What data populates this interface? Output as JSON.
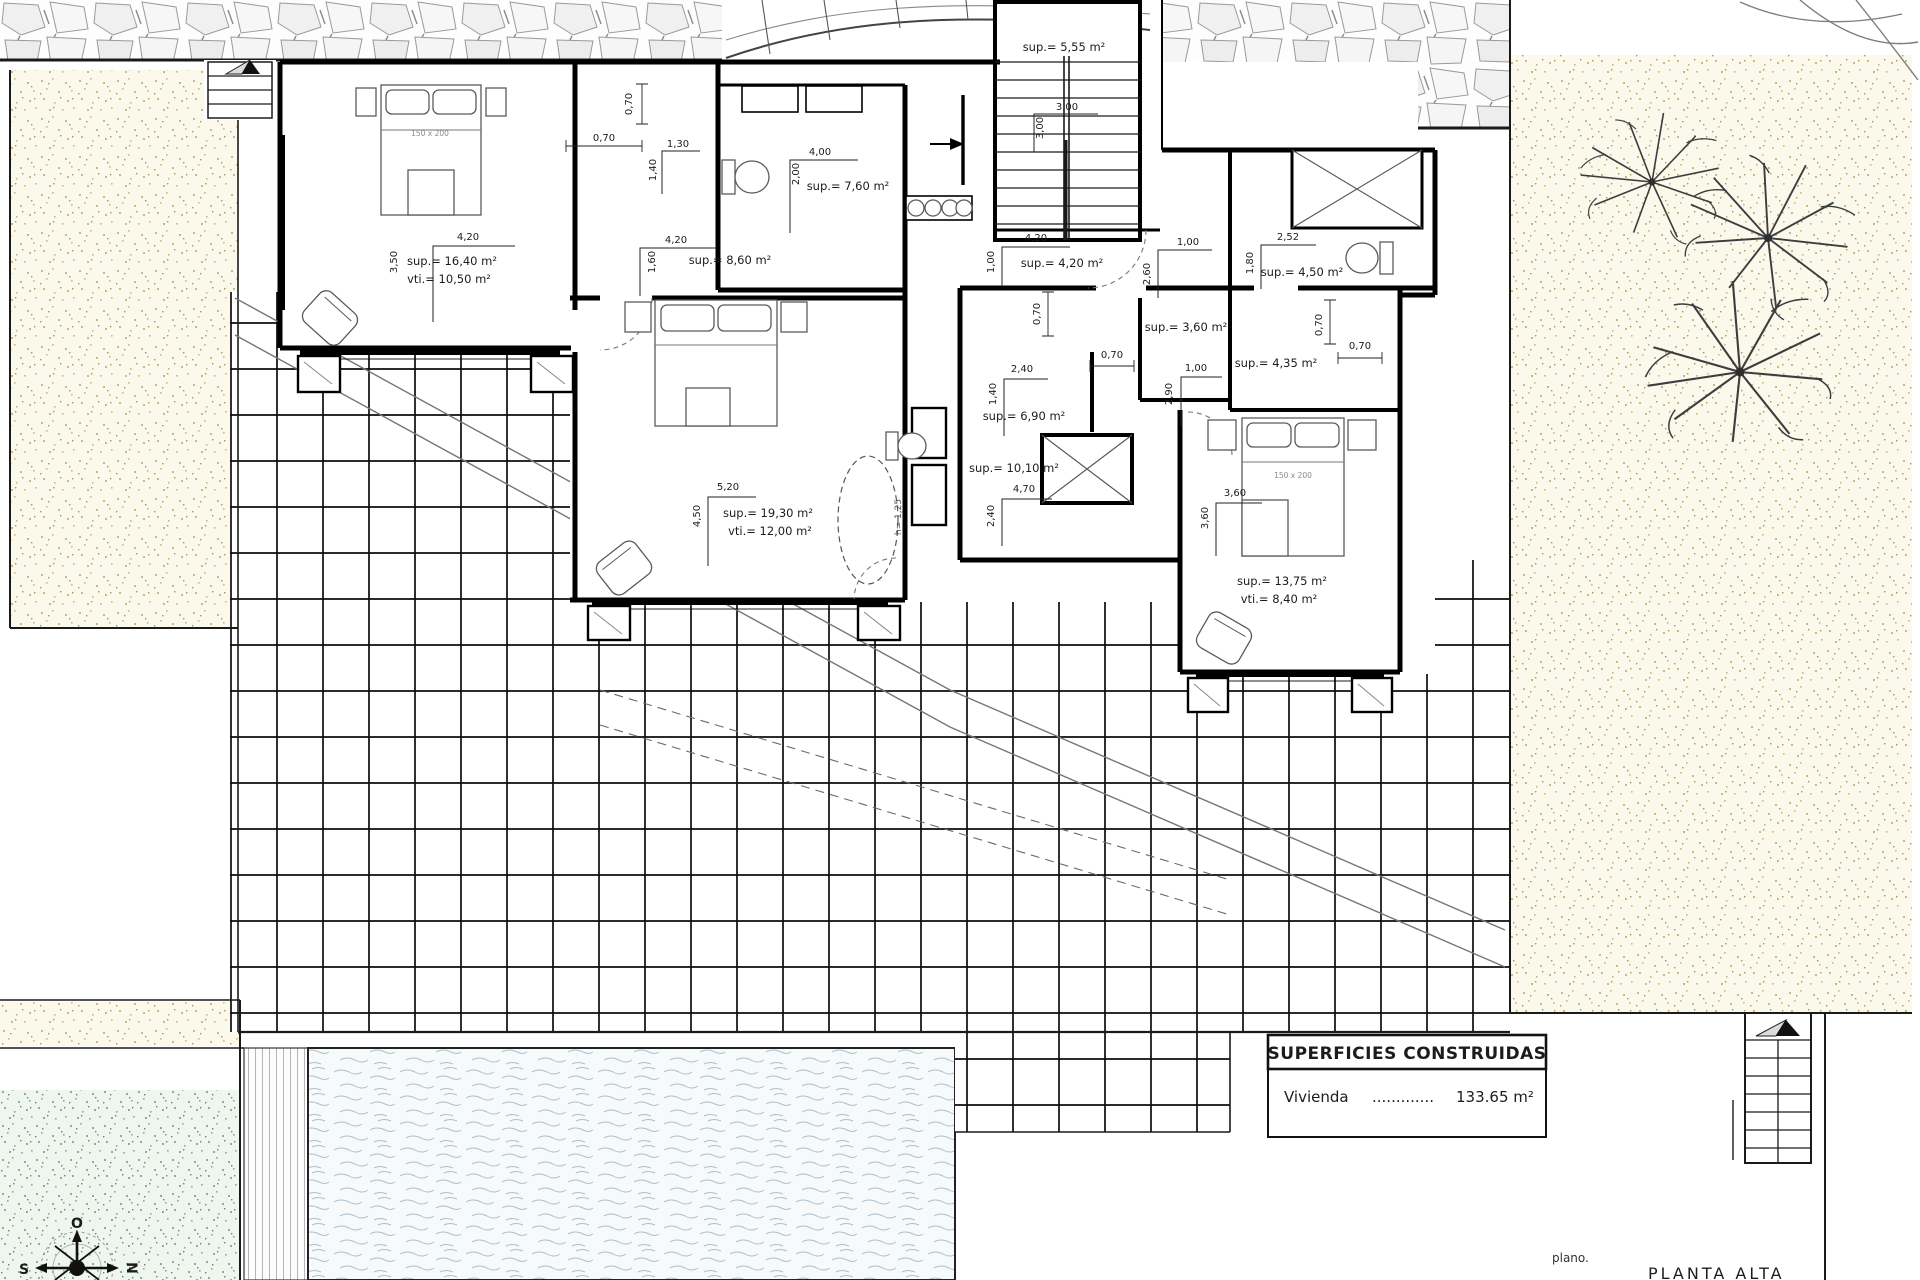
{
  "title_block": {
    "header": "SUPERFICIES CONSTRUIDAS",
    "item_label": "Vivienda",
    "item_dots": ".............",
    "item_value": "133.65 m²"
  },
  "footer": {
    "plano": "plano.",
    "plan_name": "PLANTA ALTA"
  },
  "compass": {
    "top": "O",
    "left": "S",
    "right": "N"
  },
  "beds": {
    "bed1": "150 x 200",
    "bed2": "150 x 200"
  },
  "void_label": "h= 1,25",
  "rooms": [
    {
      "name": "dormitorio-1",
      "line1": "sup.= 16,40 m²",
      "line2": "vti.= 10,50 m²"
    },
    {
      "name": "vestidor",
      "line1": "sup.= 8,60 m²"
    },
    {
      "name": "bano-1",
      "line1": "sup.= 7,60 m²"
    },
    {
      "name": "escalera",
      "line1": "sup.= 5,55 m²"
    },
    {
      "name": "pasillo",
      "line1": "sup.= 4,20 m²"
    },
    {
      "name": "bano-2",
      "line1": "sup.= 4,50 m²"
    },
    {
      "name": "aseo",
      "line1": "sup.= 3,60 m²"
    },
    {
      "name": "bano-3",
      "line1": "sup.= 4,35 m²"
    },
    {
      "name": "distribuidor",
      "line1": "sup.= 6,90 m²"
    },
    {
      "name": "bano-4",
      "line1": "sup.= 10,10 m²"
    },
    {
      "name": "dormitorio-2",
      "line1": "sup.= 19,30 m²",
      "line2": "vti.= 12,00 m²"
    },
    {
      "name": "dormitorio-3",
      "line1": "sup.= 13,75 m²",
      "line2": "vti.= 8,40 m²"
    }
  ],
  "dims": [
    "4,20",
    "3,50",
    "0,70",
    "0,70",
    "1,30",
    "1,40",
    "4,20",
    "1,60",
    "4,00",
    "2,00",
    "3,00",
    "3,00",
    "4,20",
    "1,00",
    "1,00",
    "2,60",
    "0,70",
    "2,52",
    "1,80",
    "0,70",
    "0,70",
    "2,40",
    "1,40",
    "0,70",
    "1,00",
    "2,90",
    "4,70",
    "2,40",
    "5,20",
    "4,50",
    "3,60",
    "3,60"
  ]
}
